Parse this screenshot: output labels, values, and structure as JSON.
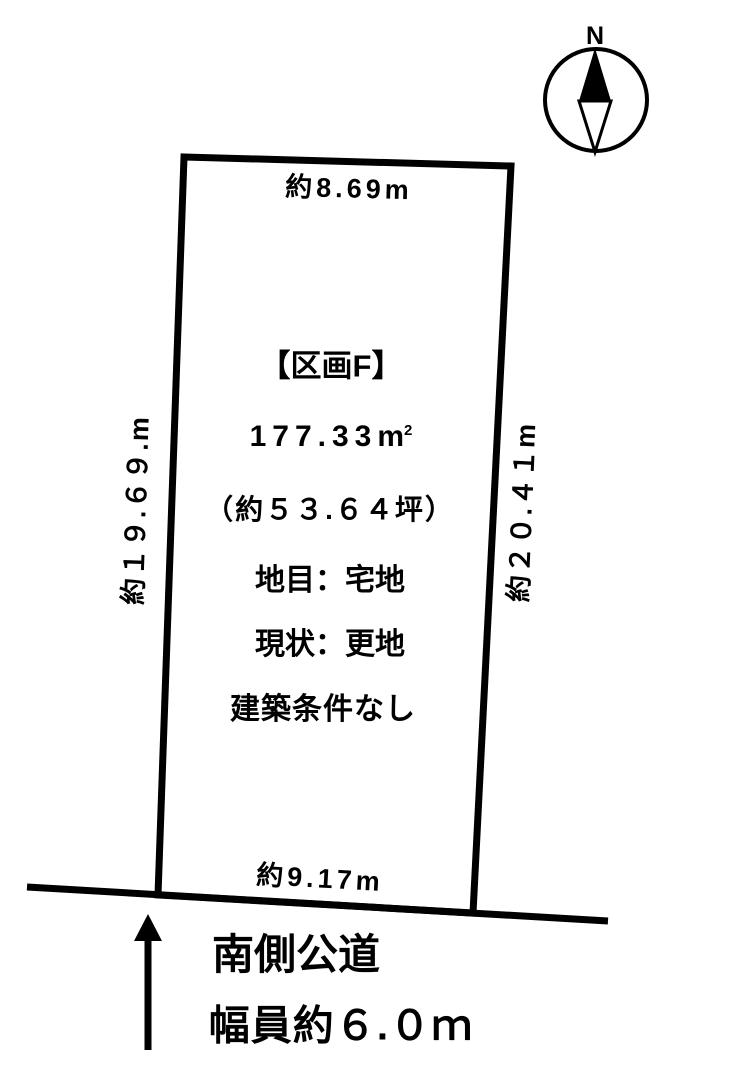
{
  "page": {
    "background_color": "#ffffff",
    "ink_color": "#000000"
  },
  "compass": {
    "label": "N"
  },
  "plot": {
    "title": "【区画F】",
    "area": {
      "value": "177.33",
      "unit": "m",
      "exponent": "2"
    },
    "area_tsubo": "（約５３.６４坪）",
    "land_category": "地目：宅地",
    "current_state": "現状：更地",
    "building_condition": "建築条件なし",
    "dimensions": {
      "top": "約8.69m",
      "bottom": "約9.17m",
      "left": "約１９.６９.m",
      "right": "約２０.４１m"
    }
  },
  "road": {
    "name": "南側公道",
    "width": "幅員約６.０ｍ"
  }
}
